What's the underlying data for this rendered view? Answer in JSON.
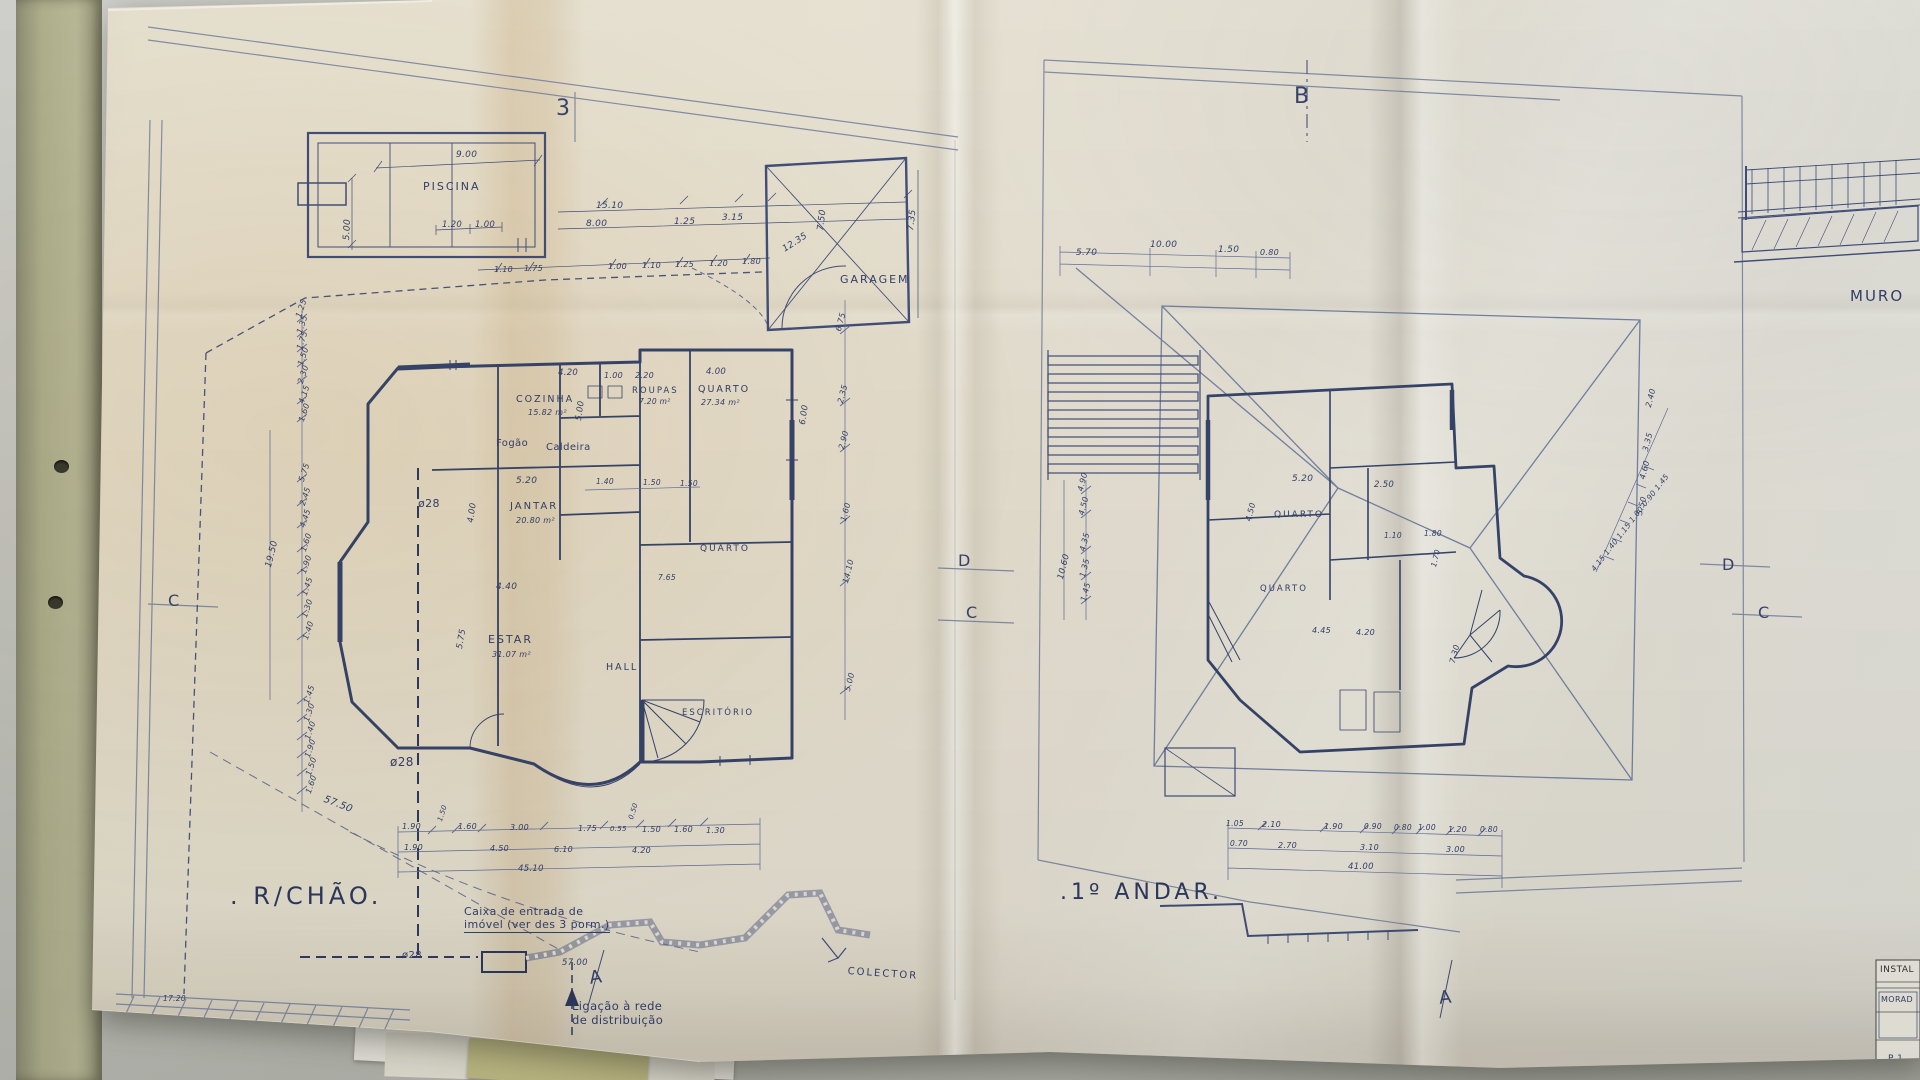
{
  "colors": {
    "ink": "#3d4a78",
    "pencil": "#7d87a6",
    "paper": "#ece6d8",
    "desk": "#c6c7c1",
    "fold_tan": "#d8c49e"
  },
  "plans": {
    "ground_floor": {
      "title": ". R/CHÃO."
    },
    "first_floor": {
      "title": ".1º ANDAR."
    }
  },
  "annotations": {
    "left_plan": [
      {
        "n": "section-marker-3",
        "t": "3",
        "x": 556,
        "y": 96,
        "s": 22,
        "c": "marker"
      },
      {
        "n": "pool-label",
        "t": "PISCINA",
        "x": 423,
        "y": 181,
        "s": 11,
        "c": "room"
      },
      {
        "n": "dim",
        "t": "9.00",
        "x": 456,
        "y": 150,
        "s": 9
      },
      {
        "n": "dim",
        "t": "5.00",
        "x": 342,
        "y": 240,
        "s": 9,
        "r": -87
      },
      {
        "n": "dim",
        "t": "1.20",
        "x": 442,
        "y": 220,
        "s": 8.5
      },
      {
        "n": "dim",
        "t": "1.00",
        "x": 475,
        "y": 220,
        "s": 8.5
      },
      {
        "n": "dim",
        "t": "15.10",
        "x": 596,
        "y": 201,
        "s": 9
      },
      {
        "n": "dim",
        "t": "8.00",
        "x": 586,
        "y": 219,
        "s": 9
      },
      {
        "n": "dim",
        "t": "1.25",
        "x": 674,
        "y": 217,
        "s": 9
      },
      {
        "n": "dim",
        "t": "3.15",
        "x": 722,
        "y": 213,
        "s": 9
      },
      {
        "n": "dim",
        "t": "1.10",
        "x": 494,
        "y": 265,
        "s": 8
      },
      {
        "n": "dim",
        "t": "1.75",
        "x": 524,
        "y": 264,
        "s": 8
      },
      {
        "n": "dim",
        "t": "1.00",
        "x": 608,
        "y": 262,
        "s": 8
      },
      {
        "n": "dim",
        "t": "1.10",
        "x": 642,
        "y": 261,
        "s": 8
      },
      {
        "n": "dim",
        "t": "1.25",
        "x": 675,
        "y": 260,
        "s": 8
      },
      {
        "n": "dim",
        "t": "1.20",
        "x": 709,
        "y": 259,
        "s": 8
      },
      {
        "n": "dim",
        "t": "1.80",
        "x": 742,
        "y": 257,
        "s": 8
      },
      {
        "n": "garage-label",
        "t": "GARAGEM",
        "x": 840,
        "y": 274,
        "s": 11,
        "c": "room"
      },
      {
        "n": "dim",
        "t": "12.35",
        "x": 781,
        "y": 246,
        "s": 9,
        "r": -33
      },
      {
        "n": "dim",
        "t": "7.50",
        "x": 816,
        "y": 230,
        "s": 9,
        "r": -83
      },
      {
        "n": "dim",
        "t": "7.35",
        "x": 906,
        "y": 230,
        "s": 9,
        "r": -83
      },
      {
        "n": "dim",
        "t": "1.25",
        "x": 294,
        "y": 316,
        "s": 8,
        "r": -72
      },
      {
        "n": "dim",
        "t": "1.35",
        "x": 295,
        "y": 332,
        "s": 8,
        "r": -72
      },
      {
        "n": "dim",
        "t": "1.75",
        "x": 295,
        "y": 348,
        "s": 8,
        "r": -72
      },
      {
        "n": "dim",
        "t": "1.50",
        "x": 296,
        "y": 364,
        "s": 8,
        "r": -72
      },
      {
        "n": "dim",
        "t": "2.30",
        "x": 296,
        "y": 382,
        "s": 8,
        "r": -72
      },
      {
        "n": "dim",
        "t": "4.15",
        "x": 297,
        "y": 402,
        "s": 8,
        "r": -72
      },
      {
        "n": "dim",
        "t": "1.60",
        "x": 297,
        "y": 420,
        "s": 8,
        "r": -72
      },
      {
        "n": "dim",
        "t": "5.75",
        "x": 297,
        "y": 480,
        "s": 8,
        "r": -72
      },
      {
        "n": "dim",
        "t": "2.45",
        "x": 298,
        "y": 504,
        "s": 8,
        "r": -72
      },
      {
        "n": "dim",
        "t": "4.45",
        "x": 298,
        "y": 526,
        "s": 8,
        "r": -72
      },
      {
        "n": "dim",
        "t": "1.60",
        "x": 299,
        "y": 550,
        "s": 8,
        "r": -72
      },
      {
        "n": "dim",
        "t": "1.90",
        "x": 299,
        "y": 572,
        "s": 8,
        "r": -72
      },
      {
        "n": "dim",
        "t": "1.45",
        "x": 300,
        "y": 594,
        "s": 8,
        "r": -72
      },
      {
        "n": "dim",
        "t": "1.30",
        "x": 300,
        "y": 616,
        "s": 8,
        "r": -72
      },
      {
        "n": "dim",
        "t": "1.40",
        "x": 301,
        "y": 638,
        "s": 8,
        "r": -72
      },
      {
        "n": "dim",
        "t": "19.50",
        "x": 264,
        "y": 566,
        "s": 9,
        "r": -76
      },
      {
        "n": "dim",
        "t": "1.45",
        "x": 302,
        "y": 702,
        "s": 8,
        "r": -72
      },
      {
        "n": "dim",
        "t": "1.30",
        "x": 302,
        "y": 720,
        "s": 8,
        "r": -72
      },
      {
        "n": "dim",
        "t": "1.40",
        "x": 303,
        "y": 738,
        "s": 8,
        "r": -72
      },
      {
        "n": "dim",
        "t": "1.90",
        "x": 303,
        "y": 756,
        "s": 8,
        "r": -72
      },
      {
        "n": "dim",
        "t": "1.50",
        "x": 304,
        "y": 774,
        "s": 8,
        "r": -72
      },
      {
        "n": "dim",
        "t": "1.60",
        "x": 304,
        "y": 792,
        "s": 8,
        "r": -72
      },
      {
        "n": "dim",
        "t": "57.50",
        "x": 326,
        "y": 794,
        "s": 10,
        "r": 21
      },
      {
        "n": "pipe-diameter-label",
        "t": "ø28",
        "x": 418,
        "y": 498,
        "s": 11,
        "c": "note"
      },
      {
        "n": "pipe-diameter-label",
        "t": "ø28",
        "x": 390,
        "y": 755,
        "s": 12,
        "c": "note"
      },
      {
        "n": "pipe-diameter-label",
        "t": "ø28",
        "x": 402,
        "y": 950,
        "s": 10,
        "c": "note"
      },
      {
        "n": "dim",
        "t": "17.20",
        "x": 163,
        "y": 995,
        "s": 7.5
      },
      {
        "n": "dim",
        "t": "6.75",
        "x": 834,
        "y": 330,
        "s": 8,
        "r": -76
      },
      {
        "n": "dim",
        "t": "2.35",
        "x": 836,
        "y": 402,
        "s": 8,
        "r": -76
      },
      {
        "n": "dim",
        "t": "2.90",
        "x": 837,
        "y": 448,
        "s": 8,
        "r": -76
      },
      {
        "n": "dim",
        "t": "1.60",
        "x": 839,
        "y": 520,
        "s": 8,
        "r": -76
      },
      {
        "n": "dim",
        "t": "14.10",
        "x": 841,
        "y": 582,
        "s": 8,
        "r": -76
      },
      {
        "n": "dim",
        "t": "5.00",
        "x": 843,
        "y": 690,
        "s": 8,
        "r": -76
      },
      {
        "n": "room-label-cozinha",
        "t": "COZINHA",
        "x": 516,
        "y": 394,
        "s": 9.5,
        "c": "room"
      },
      {
        "n": "room-area",
        "t": "15.82 m²",
        "x": 528,
        "y": 408,
        "s": 8
      },
      {
        "n": "dim",
        "t": "5.00",
        "x": 574,
        "y": 420,
        "s": 8.5,
        "r": -82
      },
      {
        "n": "dim",
        "t": "4.20",
        "x": 558,
        "y": 368,
        "s": 8.5
      },
      {
        "n": "dim",
        "t": "1.00",
        "x": 604,
        "y": 371,
        "s": 8
      },
      {
        "n": "dim",
        "t": "2.20",
        "x": 635,
        "y": 371,
        "s": 8
      },
      {
        "n": "dim",
        "t": "4.00",
        "x": 706,
        "y": 367,
        "s": 8.5
      },
      {
        "n": "dim",
        "t": "6.00",
        "x": 798,
        "y": 424,
        "s": 8.5,
        "r": -82
      },
      {
        "n": "stove-label",
        "t": "Fogão",
        "x": 496,
        "y": 438,
        "s": 10,
        "c": "note"
      },
      {
        "n": "boiler-label",
        "t": "Caldeira",
        "x": 546,
        "y": 442,
        "s": 10,
        "c": "note"
      },
      {
        "n": "dim",
        "t": "5.20",
        "x": 516,
        "y": 476,
        "s": 9
      },
      {
        "n": "room-label-jantar",
        "t": "JANTAR",
        "x": 510,
        "y": 501,
        "s": 10,
        "c": "room"
      },
      {
        "n": "room-area",
        "t": "20.80 m²",
        "x": 516,
        "y": 516,
        "s": 8
      },
      {
        "n": "dim",
        "t": "4.00",
        "x": 466,
        "y": 522,
        "s": 8.5,
        "r": -82
      },
      {
        "n": "dim",
        "t": "4.40",
        "x": 496,
        "y": 582,
        "s": 9
      },
      {
        "n": "dim",
        "t": "1.40",
        "x": 596,
        "y": 478,
        "s": 7.5
      },
      {
        "n": "dim",
        "t": "1.50",
        "x": 643,
        "y": 479,
        "s": 7.5
      },
      {
        "n": "dim",
        "t": "1.50",
        "x": 680,
        "y": 480,
        "s": 7.5
      },
      {
        "n": "room-label-estar",
        "t": "ESTAR",
        "x": 488,
        "y": 634,
        "s": 11,
        "c": "room"
      },
      {
        "n": "room-area",
        "t": "31.07 m²",
        "x": 492,
        "y": 650,
        "s": 8
      },
      {
        "n": "dim",
        "t": "5.75",
        "x": 455,
        "y": 648,
        "s": 8.5,
        "r": -80
      },
      {
        "n": "room-label-hall",
        "t": "HALL",
        "x": 606,
        "y": 662,
        "s": 9.5,
        "c": "room"
      },
      {
        "n": "room-label-quarto-mid",
        "t": "QUARTO",
        "x": 700,
        "y": 544,
        "s": 9,
        "c": "room"
      },
      {
        "n": "dim",
        "t": "7.65",
        "x": 658,
        "y": 574,
        "s": 7.5
      },
      {
        "n": "room-label-escritorio",
        "t": "ESCRITÓRIO",
        "x": 682,
        "y": 708,
        "s": 8.5,
        "c": "room"
      },
      {
        "n": "room-label-roupas",
        "t": "ROUPAS",
        "x": 632,
        "y": 386,
        "s": 8.5,
        "c": "room"
      },
      {
        "n": "room-area",
        "t": "7.20 m²",
        "x": 639,
        "y": 398,
        "s": 7.5
      },
      {
        "n": "room-label-quarto27",
        "t": "QUARTO",
        "x": 698,
        "y": 384,
        "s": 9.5,
        "c": "room"
      },
      {
        "n": "room-area",
        "t": "27.34 m²",
        "x": 701,
        "y": 398,
        "s": 8
      },
      {
        "n": "dim",
        "t": "1.90",
        "x": 402,
        "y": 822,
        "s": 8
      },
      {
        "n": "dim",
        "t": "1.50",
        "x": 436,
        "y": 820,
        "s": 7,
        "r": -72
      },
      {
        "n": "dim",
        "t": "1.60",
        "x": 458,
        "y": 822,
        "s": 8
      },
      {
        "n": "dim",
        "t": "3.00",
        "x": 510,
        "y": 823,
        "s": 8
      },
      {
        "n": "dim",
        "t": "1.75",
        "x": 578,
        "y": 824,
        "s": 8
      },
      {
        "n": "dim",
        "t": "0.55",
        "x": 610,
        "y": 825,
        "s": 7
      },
      {
        "n": "dim",
        "t": "0.50",
        "x": 627,
        "y": 818,
        "s": 7,
        "r": -72
      },
      {
        "n": "dim",
        "t": "1.50",
        "x": 642,
        "y": 825,
        "s": 8
      },
      {
        "n": "dim",
        "t": "1.60",
        "x": 674,
        "y": 825,
        "s": 8
      },
      {
        "n": "dim",
        "t": "1.30",
        "x": 706,
        "y": 826,
        "s": 8
      },
      {
        "n": "dim",
        "t": "1.90",
        "x": 404,
        "y": 843,
        "s": 8
      },
      {
        "n": "dim",
        "t": "4.50",
        "x": 490,
        "y": 844,
        "s": 8
      },
      {
        "n": "dim",
        "t": "6.10",
        "x": 554,
        "y": 845,
        "s": 8
      },
      {
        "n": "dim",
        "t": "4.20",
        "x": 632,
        "y": 846,
        "s": 8
      },
      {
        "n": "dim",
        "t": "45.10",
        "x": 518,
        "y": 864,
        "s": 8.5
      },
      {
        "n": "section-marker-c-left",
        "t": "C",
        "x": 168,
        "y": 592,
        "s": 16,
        "c": "marker"
      },
      {
        "n": "section-marker-d-mid",
        "t": "D",
        "x": 958,
        "y": 552,
        "s": 16,
        "c": "marker"
      },
      {
        "n": "section-marker-c-mid",
        "t": "C",
        "x": 966,
        "y": 604,
        "s": 16,
        "c": "marker"
      },
      {
        "n": "section-marker-a-left",
        "t": "A",
        "x": 588,
        "y": 968,
        "s": 18,
        "c": "marker",
        "r": -8
      },
      {
        "n": "ground-floor-title",
        "t": ". R/CHÃO.",
        "x": 230,
        "y": 882,
        "s": 24,
        "c": "title"
      },
      {
        "n": "note-caixa",
        "t": "Caixa de entrada de\nimóvel (ver des 3 porm.)",
        "x": 464,
        "y": 906,
        "s": 11,
        "c": "note u"
      },
      {
        "n": "dim",
        "t": "57.00",
        "x": 562,
        "y": 958,
        "s": 8.5
      },
      {
        "n": "note-ligacao",
        "t": "Ligação à rede\nde distribuição",
        "x": 572,
        "y": 1000,
        "s": 11.5,
        "c": "note"
      },
      {
        "n": "colector-label",
        "t": "COLECTOR",
        "x": 848,
        "y": 966,
        "s": 10,
        "c": "room",
        "r": 4
      }
    ],
    "right_plan": [
      {
        "n": "section-marker-b",
        "t": "B",
        "x": 1294,
        "y": 84,
        "s": 22,
        "c": "marker"
      },
      {
        "n": "dim",
        "t": "5.70",
        "x": 1076,
        "y": 248,
        "s": 9
      },
      {
        "n": "dim",
        "t": "10.00",
        "x": 1150,
        "y": 240,
        "s": 9
      },
      {
        "n": "dim",
        "t": "1.50",
        "x": 1218,
        "y": 245,
        "s": 9
      },
      {
        "n": "dim",
        "t": "0.80",
        "x": 1260,
        "y": 248,
        "s": 8
      },
      {
        "n": "dim",
        "t": "4.90",
        "x": 1076,
        "y": 490,
        "s": 8,
        "r": -76
      },
      {
        "n": "dim",
        "t": "4.50",
        "x": 1077,
        "y": 514,
        "s": 8,
        "r": -76
      },
      {
        "n": "dim",
        "t": "4.35",
        "x": 1078,
        "y": 550,
        "s": 8,
        "r": -76
      },
      {
        "n": "dim",
        "t": "1.35",
        "x": 1078,
        "y": 576,
        "s": 8,
        "r": -76
      },
      {
        "n": "dim",
        "t": "1.45",
        "x": 1079,
        "y": 600,
        "s": 8,
        "r": -76
      },
      {
        "n": "dim",
        "t": "10.60",
        "x": 1056,
        "y": 578,
        "s": 8.5,
        "r": -76
      },
      {
        "n": "dim",
        "t": "5.20",
        "x": 1292,
        "y": 474,
        "s": 9
      },
      {
        "n": "dim",
        "t": "2.50",
        "x": 1374,
        "y": 480,
        "s": 8.5
      },
      {
        "n": "dim",
        "t": "4.50",
        "x": 1244,
        "y": 520,
        "s": 8,
        "r": -76
      },
      {
        "n": "room-label-quarto1",
        "t": "QUARTO",
        "x": 1274,
        "y": 510,
        "s": 9,
        "c": "room"
      },
      {
        "n": "room-label-quarto2",
        "t": "QUARTO",
        "x": 1260,
        "y": 584,
        "s": 8.5,
        "c": "room"
      },
      {
        "n": "dim",
        "t": "1.10",
        "x": 1384,
        "y": 532,
        "s": 7.5
      },
      {
        "n": "dim",
        "t": "1.80",
        "x": 1424,
        "y": 530,
        "s": 7.5
      },
      {
        "n": "dim",
        "t": "1.70",
        "x": 1430,
        "y": 566,
        "s": 7.5,
        "r": -76
      },
      {
        "n": "dim",
        "t": "4.45",
        "x": 1312,
        "y": 626,
        "s": 8
      },
      {
        "n": "dim",
        "t": "4.20",
        "x": 1356,
        "y": 628,
        "s": 8
      },
      {
        "n": "dim",
        "t": "7.30",
        "x": 1448,
        "y": 662,
        "s": 8,
        "r": -76
      },
      {
        "n": "dim",
        "t": "2.40",
        "x": 1644,
        "y": 406,
        "s": 8,
        "r": -76
      },
      {
        "n": "dim",
        "t": "3.35",
        "x": 1641,
        "y": 450,
        "s": 8,
        "r": -76
      },
      {
        "n": "dim",
        "t": "4.60",
        "x": 1638,
        "y": 478,
        "s": 8,
        "r": -76
      },
      {
        "n": "dim",
        "t": "5.50",
        "x": 1635,
        "y": 514,
        "s": 8,
        "r": -76
      },
      {
        "n": "dim-chain-diagonal",
        "t": "4.15  1.40  1.15  1.00  0.90  1.45",
        "x": 1590,
        "y": 568,
        "s": 7.5,
        "r": -52
      },
      {
        "n": "dim",
        "t": "1.05",
        "x": 1226,
        "y": 820,
        "s": 7.5
      },
      {
        "n": "dim",
        "t": "2.10",
        "x": 1262,
        "y": 820,
        "s": 8
      },
      {
        "n": "dim",
        "t": "1.90",
        "x": 1324,
        "y": 822,
        "s": 8
      },
      {
        "n": "dim",
        "t": "0.90",
        "x": 1364,
        "y": 823,
        "s": 7.5
      },
      {
        "n": "dim",
        "t": "0.80",
        "x": 1394,
        "y": 824,
        "s": 7.5
      },
      {
        "n": "dim",
        "t": "1.00",
        "x": 1418,
        "y": 824,
        "s": 7.5
      },
      {
        "n": "dim",
        "t": "1.20",
        "x": 1448,
        "y": 825,
        "s": 8
      },
      {
        "n": "dim",
        "t": "0.80",
        "x": 1480,
        "y": 826,
        "s": 7.5
      },
      {
        "n": "dim",
        "t": "0.70",
        "x": 1230,
        "y": 840,
        "s": 7.5
      },
      {
        "n": "dim",
        "t": "2.70",
        "x": 1278,
        "y": 841,
        "s": 8
      },
      {
        "n": "dim",
        "t": "3.10",
        "x": 1360,
        "y": 843,
        "s": 8
      },
      {
        "n": "dim",
        "t": "3.00",
        "x": 1446,
        "y": 845,
        "s": 8
      },
      {
        "n": "dim",
        "t": "41.00",
        "x": 1348,
        "y": 862,
        "s": 8.5
      },
      {
        "n": "first-floor-title",
        "t": ".1º ANDAR.",
        "x": 1060,
        "y": 880,
        "s": 22,
        "c": "title"
      },
      {
        "n": "section-marker-a-right",
        "t": "A",
        "x": 1438,
        "y": 988,
        "s": 18,
        "c": "marker",
        "r": -6
      },
      {
        "n": "section-marker-d-right",
        "t": "D",
        "x": 1722,
        "y": 556,
        "s": 16,
        "c": "marker"
      },
      {
        "n": "section-marker-c-right",
        "t": "C",
        "x": 1758,
        "y": 604,
        "s": 16,
        "c": "marker"
      }
    ],
    "sheet_misc": [
      {
        "n": "muro-label",
        "t": "MURO",
        "x": 1850,
        "y": 288,
        "s": 15,
        "c": "room"
      },
      {
        "n": "titleblock-instal",
        "t": "INSTAL",
        "x": 1880,
        "y": 965,
        "s": 9,
        "c": "print"
      },
      {
        "n": "titleblock-morad",
        "t": "MORAD",
        "x": 1881,
        "y": 995,
        "s": 8,
        "c": "note"
      },
      {
        "n": "titleblock-p1",
        "t": "P 1",
        "x": 1888,
        "y": 1054,
        "s": 9,
        "c": "note"
      }
    ]
  }
}
